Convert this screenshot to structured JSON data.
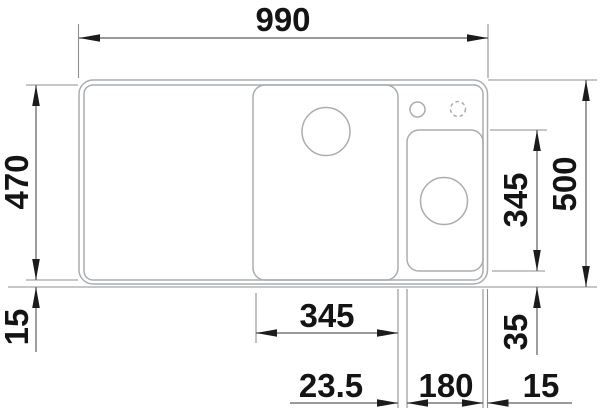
{
  "drawing": {
    "title": "sink-dimension-drawing-top-view",
    "canvas": {
      "width": 600,
      "height": 413
    },
    "colors": {
      "background": "#ffffff",
      "product_outline": "#a9adb0",
      "extension_line": "#8b8f92",
      "dimension_line": "#5a5d5f",
      "arrow": "#1c1c1c",
      "label_text": "#141414"
    },
    "label_font_size": 33,
    "shapes": [
      {
        "id": "sink-outer-edge",
        "kind": "rrect",
        "x": 79,
        "y": 80,
        "w": 408.5,
        "h": 204,
        "r": 14
      },
      {
        "id": "sink-inner-edge",
        "kind": "rrect",
        "x": 84,
        "y": 85,
        "w": 399,
        "h": 195,
        "r": 9
      },
      {
        "id": "main-bowl",
        "kind": "rrect",
        "x": 253,
        "y": 85,
        "w": 145,
        "h": 195,
        "r": 12
      },
      {
        "id": "accessory-bowl",
        "kind": "rrect",
        "x": 407,
        "y": 130,
        "w": 76,
        "h": 141,
        "r": 12
      },
      {
        "id": "main-bowl-drain-circle",
        "kind": "circle",
        "cx": 326,
        "cy": 131.5,
        "r": 24,
        "dashed": false
      },
      {
        "id": "accessory-bowl-drain-circle",
        "kind": "circle",
        "cx": 444,
        "cy": 201,
        "r": 23.5,
        "dashed": false
      },
      {
        "id": "tap-hole-circle",
        "kind": "circle",
        "cx": 417.5,
        "cy": 109.5,
        "r": 7.5,
        "dashed": false
      },
      {
        "id": "tap-hole-optional-circle",
        "kind": "circle",
        "cx": 458,
        "cy": 109,
        "r": 7.5,
        "dashed": true
      }
    ],
    "extension_lines": [
      {
        "id": "ext-total-width-left",
        "x1": 78.5,
        "y1": 24,
        "x2": 78.5,
        "y2": 78
      },
      {
        "id": "ext-total-width-right",
        "x1": 488,
        "y1": 24,
        "x2": 488,
        "y2": 78
      },
      {
        "id": "ext-inner-top-left",
        "x1": 26,
        "y1": 85,
        "x2": 78,
        "y2": 85
      },
      {
        "id": "ext-inner-bottom-left",
        "x1": 26,
        "y1": 280,
        "x2": 78,
        "y2": 280
      },
      {
        "id": "ext-baseline-long",
        "x1": 8,
        "y1": 287,
        "x2": 597,
        "y2": 287
      },
      {
        "id": "ext-total-depth-top",
        "x1": 488,
        "y1": 80,
        "x2": 597,
        "y2": 80
      },
      {
        "id": "ext-accessory-top",
        "x1": 490,
        "y1": 130,
        "x2": 547,
        "y2": 130
      },
      {
        "id": "ext-accessory-bottom",
        "x1": 492,
        "y1": 271,
        "x2": 545,
        "y2": 271
      },
      {
        "id": "ext-main-bowl-left",
        "x1": 256,
        "y1": 293,
        "x2": 256,
        "y2": 343
      },
      {
        "id": "ext-main-bowl-right",
        "x1": 398,
        "y1": 289,
        "x2": 398,
        "y2": 408
      },
      {
        "id": "ext-accessory-left",
        "x1": 407,
        "y1": 289,
        "x2": 407,
        "y2": 408
      },
      {
        "id": "ext-accessory-right",
        "x1": 483,
        "y1": 289,
        "x2": 483,
        "y2": 408
      },
      {
        "id": "ext-sink-right",
        "x1": 487.5,
        "y1": 289,
        "x2": 487.5,
        "y2": 408
      }
    ],
    "dimensions": [
      {
        "id": "dim-990",
        "label": "990",
        "x1": 79,
        "y1": 38,
        "x2": 488,
        "y2": 38,
        "arrows": [
          {
            "x": 79,
            "y": 38,
            "dir": "left"
          },
          {
            "x": 488,
            "y": 38,
            "dir": "right"
          }
        ],
        "text_x": 283,
        "text_y": 19,
        "rotated": false
      },
      {
        "id": "dim-470",
        "label": "470",
        "x1": 36,
        "y1": 85,
        "x2": 36,
        "y2": 280,
        "arrows": [
          {
            "x": 36,
            "y": 85,
            "dir": "up"
          },
          {
            "x": 36,
            "y": 280,
            "dir": "down"
          }
        ],
        "text_x": 16,
        "text_y": 182,
        "rotated": true
      },
      {
        "id": "dim-15-left",
        "label": "15",
        "x1": 36,
        "y1": 287,
        "x2": 36,
        "y2": 352,
        "arrows": [
          {
            "x": 36,
            "y": 287,
            "dir": "up"
          }
        ],
        "text_x": 16,
        "text_y": 327,
        "rotated": true
      },
      {
        "id": "dim-500",
        "label": "500",
        "x1": 586,
        "y1": 80,
        "x2": 586,
        "y2": 287,
        "arrows": [
          {
            "x": 586,
            "y": 80,
            "dir": "up"
          },
          {
            "x": 586,
            "y": 287,
            "dir": "down"
          }
        ],
        "text_x": 564,
        "text_y": 184,
        "rotated": true
      },
      {
        "id": "dim-345-right",
        "label": "345",
        "x1": 537,
        "y1": 130,
        "x2": 537,
        "y2": 271,
        "arrows": [
          {
            "x": 537,
            "y": 130,
            "dir": "up"
          },
          {
            "x": 537,
            "y": 271,
            "dir": "down"
          }
        ],
        "text_x": 515,
        "text_y": 200,
        "rotated": true
      },
      {
        "id": "dim-35",
        "label": "35",
        "x1": 537,
        "y1": 287,
        "x2": 537,
        "y2": 355,
        "arrows": [
          {
            "x": 537,
            "y": 287,
            "dir": "up"
          }
        ],
        "text_x": 515,
        "text_y": 332,
        "rotated": true
      },
      {
        "id": "dim-345-bottom",
        "label": "345",
        "x1": 256,
        "y1": 333,
        "x2": 398,
        "y2": 333,
        "arrows": [
          {
            "x": 256,
            "y": 333,
            "dir": "left"
          },
          {
            "x": 398,
            "y": 333,
            "dir": "right"
          }
        ],
        "text_x": 327,
        "text_y": 315,
        "rotated": false
      },
      {
        "id": "dim-23-5",
        "label": "23.5",
        "x1": 290,
        "y1": 403,
        "x2": 398,
        "y2": 403,
        "arrows": [
          {
            "x": 398,
            "y": 403,
            "dir": "right"
          }
        ],
        "text_x": 331,
        "text_y": 385,
        "rotated": false
      },
      {
        "id": "dim-180",
        "label": "180",
        "x1": 407,
        "y1": 403,
        "x2": 483,
        "y2": 403,
        "arrows": [
          {
            "x": 407,
            "y": 403,
            "dir": "left"
          },
          {
            "x": 483,
            "y": 403,
            "dir": "right"
          }
        ],
        "text_x": 446,
        "text_y": 385,
        "rotated": false
      },
      {
        "id": "dim-15-right",
        "label": "15",
        "x1": 487.5,
        "y1": 403,
        "x2": 572,
        "y2": 403,
        "arrows": [
          {
            "x": 487.5,
            "y": 403,
            "dir": "left"
          }
        ],
        "text_x": 541,
        "text_y": 385,
        "rotated": false
      }
    ]
  }
}
